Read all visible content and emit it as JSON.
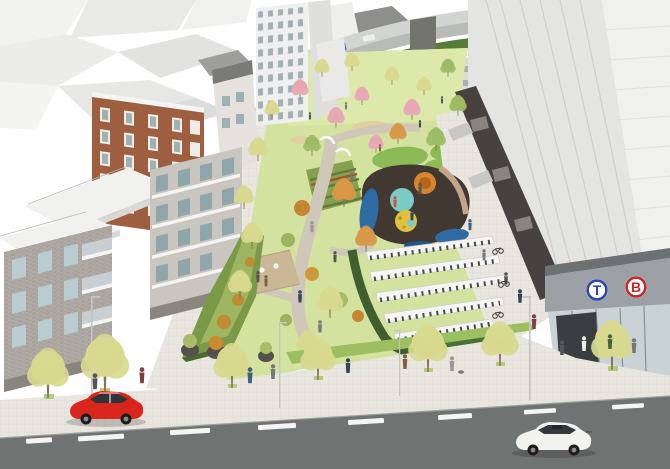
{
  "scene": {
    "kind": "architectural aerial rendering",
    "subject": "linear urban park with playground, community garden, bike shelters and a transit entrance between residential and mixed-use blocks"
  },
  "transit_entrance": {
    "line_badges": [
      {
        "label": "T",
        "color": "#2a49a5"
      },
      {
        "label": "B",
        "color": "#bf2b28"
      }
    ]
  },
  "palette": {
    "background": "#ffffff",
    "road_asphalt": "#6f7472",
    "lane_marking": "#f5f5f3",
    "sidewalk": "#e9e6e0",
    "lawn": "#d4e2a0",
    "lawn_distant": "#dde9ab",
    "mound_green": "#8cba55",
    "hedge_green": "#7a9a48",
    "hedge_dark": "#3f5f2f",
    "path_tan": "#cfc8b9",
    "flower_pink": "#ecb2c2",
    "playground_base": "#413931",
    "playground_blue": "#2e6ba3",
    "playground_teal": "#7ccbc5",
    "playground_orange": "#d8842b",
    "playground_yellow": "#e2bf3e",
    "brick": "#9e5f41",
    "facade_gray": "#b0aca5",
    "tower_panel": "#e4e4e2",
    "podium_dark": "#474240",
    "storefront_glass": "#c9d2d4",
    "canopy_gray": "#9aa0a3",
    "deck_wood": "#c9b795",
    "tree_pale": "#d8d98f",
    "tree_green": "#9cbc66",
    "tree_pink": "#e6a8b4",
    "tree_orange": "#d89848",
    "car_red": "#d8261c",
    "car_white": "#f2f2ef"
  }
}
